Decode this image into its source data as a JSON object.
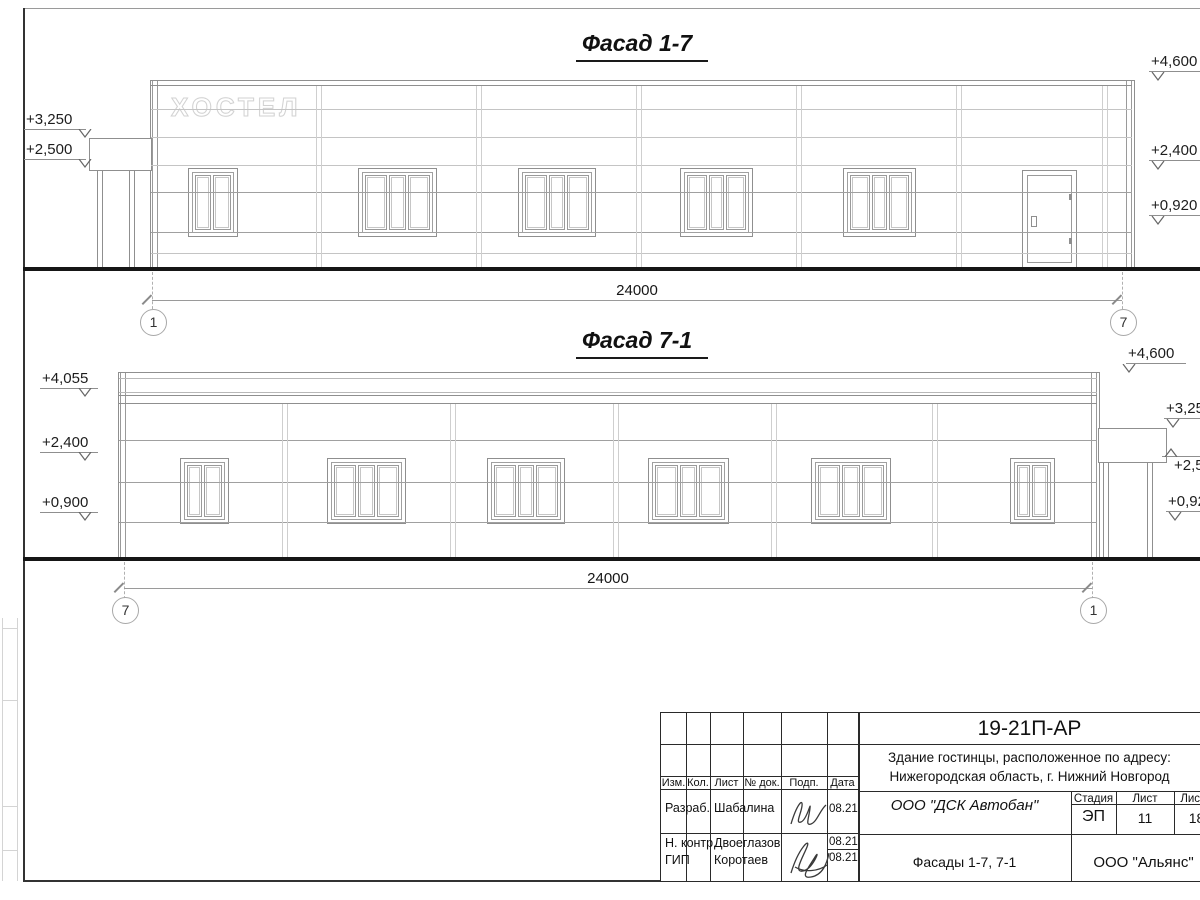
{
  "facade1": {
    "title": "Фасад 1-7",
    "sign": "ХОСТЕЛ",
    "dimension": "24000",
    "axis_left": "1",
    "axis_right": "7",
    "marks_left": [
      "+3,250",
      "+2,500"
    ],
    "marks_right": [
      "+4,600",
      "+2,400",
      "+0,920"
    ]
  },
  "facade2": {
    "title": "Фасад 7-1",
    "dimension": "24000",
    "axis_left": "7",
    "axis_right": "1",
    "marks_left": [
      "+4,055",
      "+2,400",
      "+0,900"
    ],
    "marks_right": [
      "+4,600",
      "+3,250",
      "+2,500",
      "+0,920"
    ]
  },
  "sheet": {
    "code": "19-21П-АР",
    "project_line1": "Здание гостинцы, расположенное по адресу:",
    "project_line2": "Нижегородская область, г. Нижний Новгород",
    "contractor": "ООО \"ДСК Автобан\"",
    "stage_label": "Стадия",
    "sheet_label": "Лист",
    "sheets_label": "Листов",
    "stage": "ЭП",
    "sheet_no": "11",
    "sheets_total": "18",
    "drawing_title": "Фасады 1-7, 7-1",
    "company": "ООО \"Альянс\"",
    "header_cols": [
      "Изм.",
      "Кол.",
      "Лист",
      "№ док.",
      "Подп.",
      "Дата"
    ],
    "rows": [
      {
        "role": "Разраб.",
        "name": "Шабалина",
        "date": "08.21"
      },
      {
        "role": "Н. контр.",
        "name": "Двоеглазов",
        "date": "08.21"
      },
      {
        "role": "ГИП",
        "name": "Коротаев",
        "date": "08.21"
      }
    ]
  }
}
